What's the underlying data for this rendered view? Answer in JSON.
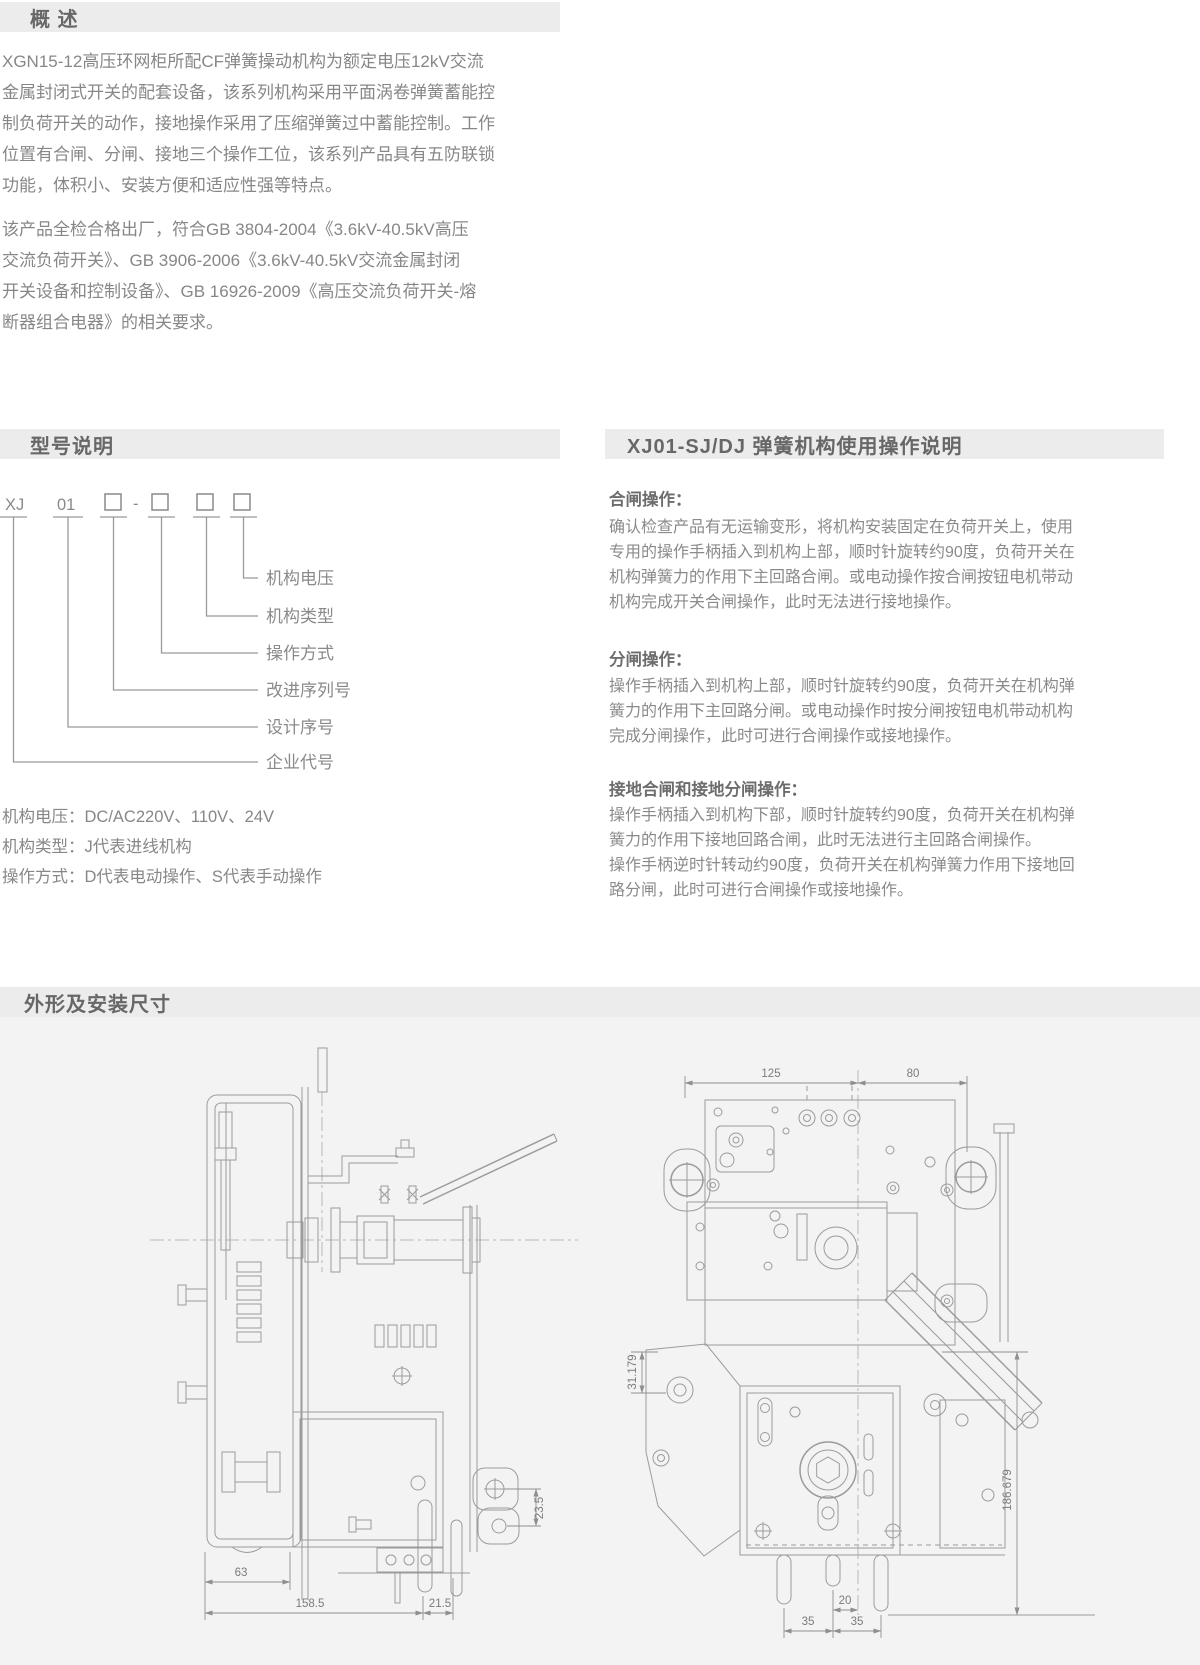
{
  "sections": {
    "overview": {
      "title": "概 述",
      "p1": "XGN15-12高压环网柜所配CF弹簧操动机构为额定电压12kV交流\n金属封闭式开关的配套设备，该系列机构采用平面涡卷弹簧蓄能控\n制负荷开关的动作，接地操作采用了压缩弹簧过中蓄能控制。工作\n位置有合闸、分闸、接地三个操作工位，该系列产品具有五防联锁\n功能，体积小、安装方便和适应性强等特点。",
      "p2": "该产品全检合格出厂，符合GB 3804-2004《3.6kV-40.5kV高压\n交流负荷开关》、GB 3906-2006《3.6kV-40.5kV交流金属封闭\n开关设备和控制设备》、GB 16926-2009《高压交流负荷开关-熔\n断器组合电器》的相关要求。"
    },
    "model": {
      "title": "型号说明",
      "code": [
        "XJ",
        "01",
        "□",
        "-",
        "□",
        "□",
        "□"
      ],
      "labels": [
        "机构电压",
        "机构类型",
        "操作方式",
        "改进序列号",
        "设计序号",
        "企业代号"
      ],
      "notes": "机构电压：DC/AC220V、110V、24V\n机构类型：J代表进线机构\n操作方式：D代表电动操作、S代表手动操作"
    },
    "operation": {
      "title": "XJ01-SJ/DJ 弹簧机构使用操作说明",
      "blocks": [
        {
          "title": "合闸操作：",
          "body": "确认检查产品有无运输变形，将机构安装固定在负荷开关上，使用\n专用的操作手柄插入到机构上部，顺时针旋转约90度，负荷开关在\n机构弹簧力的作用下主回路合闸。或电动操作按合闸按钮电机带动\n机构完成开关合闸操作，此时无法进行接地操作。"
        },
        {
          "title": "分闸操作：",
          "body": "操作手柄插入到机构上部，顺时针旋转约90度，负荷开关在机构弹\n簧力的作用下主回路分闸。或电动操作时按分闸按钮电机带动机构\n完成分闸操作，此时可进行合闸操作或接地操作。"
        },
        {
          "title": "接地合闸和接地分闸操作：",
          "body": "操作手柄插入到机构下部，顺时针旋转约90度，负荷开关在机构弹\n簧力的作用下接地回路合闸，此时无法进行主回路合闸操作。\n操作手柄逆时针转动约90度，负荷开关在机构弹簧力作用下接地回\n路分闸，此时可进行合闸操作或接地操作。"
        }
      ]
    },
    "dimensions": {
      "title": "外形及安装尺寸",
      "left_view": {
        "d63": "63",
        "d158_5": "158.5",
        "d21_5": "21.5",
        "d23_5": "23.5"
      },
      "right_view": {
        "d125": "125",
        "d80": "80",
        "d31": "31.179",
        "d186": "186.679",
        "d20": "20",
        "d35_left": "35",
        "d35_right": "35"
      }
    }
  },
  "colors": {
    "header_bar_bg": "#ececec",
    "header_text": "#676767",
    "body_text": "#878787",
    "drawing_bg": "#f3f3f3",
    "drawing_line": "#9b9b9b"
  }
}
